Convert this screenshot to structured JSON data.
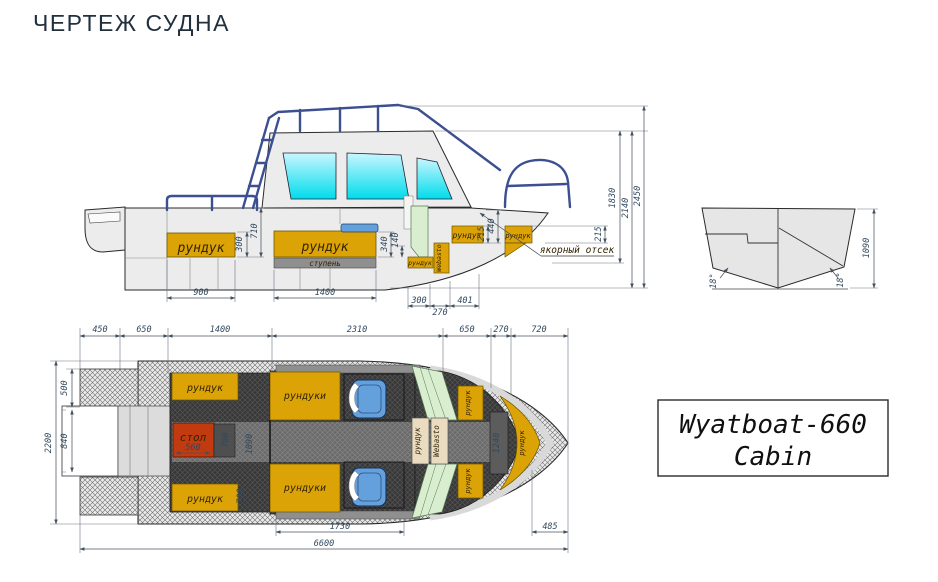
{
  "title": "ЧЕРТЕЖ СУДНА",
  "badge": {
    "line1": "Wyatboat-660",
    "line2": "Cabin"
  },
  "colors": {
    "locker_orange": "#dca307",
    "table_red": "#c23a10",
    "seat_blue": "#64a0dc",
    "glass_top": "#c9f6ff",
    "glass_bottom": "#00dcec",
    "rail_blue": "#3b4f91",
    "panel_green": "#d8eecf",
    "step_gray": "#8f8f8f",
    "console_tan": "#e9dcc0"
  },
  "side_view": {
    "labels": {
      "locker1": "рундук",
      "locker2": "рундук",
      "locker3": "рундук",
      "locker4": "рундук",
      "locker5": "рундук",
      "step": "ступень",
      "webasto": "Webasto",
      "anchor": "якорный отсек"
    },
    "dims": {
      "w900": "900",
      "w1400": "1400",
      "w300": "300",
      "w270": "270",
      "w401": "401",
      "h300": "300",
      "h710": "710",
      "h340": "340",
      "h140": "140",
      "h215a": "215",
      "h440": "440",
      "h215b": "215",
      "h1830": "1830",
      "h2140": "2140",
      "h2450": "2450"
    }
  },
  "transom_view": {
    "dims": {
      "h1090": "1090",
      "angle_left": "18°",
      "angle_right": "18°"
    }
  },
  "plan_view": {
    "top_dims": [
      "450",
      "650",
      "1400",
      "2310",
      "650",
      "270",
      "720"
    ],
    "side_dims": {
      "d500": "500",
      "d840": "840",
      "d2200": "2200"
    },
    "bottom_dims": {
      "d560": "560",
      "d1730": "1730",
      "d485": "485",
      "d6600": "6600"
    },
    "labels": {
      "locker_aft_top": "рундук",
      "locker_aft_bottom": "рундук",
      "table": "стол",
      "lockers_mid_top": "рундуки",
      "lockers_mid_bottom": "рундуки",
      "console_locker": "рундук",
      "console_webasto": "Webasto",
      "bow_locker_top": "рундук",
      "bow_locker_bottom": "рундук",
      "bow_locker_side": "рундук"
    },
    "inner_dims": {
      "d700a": "700",
      "d1090": "1090",
      "d700b": "700",
      "d1240": "1240"
    }
  }
}
